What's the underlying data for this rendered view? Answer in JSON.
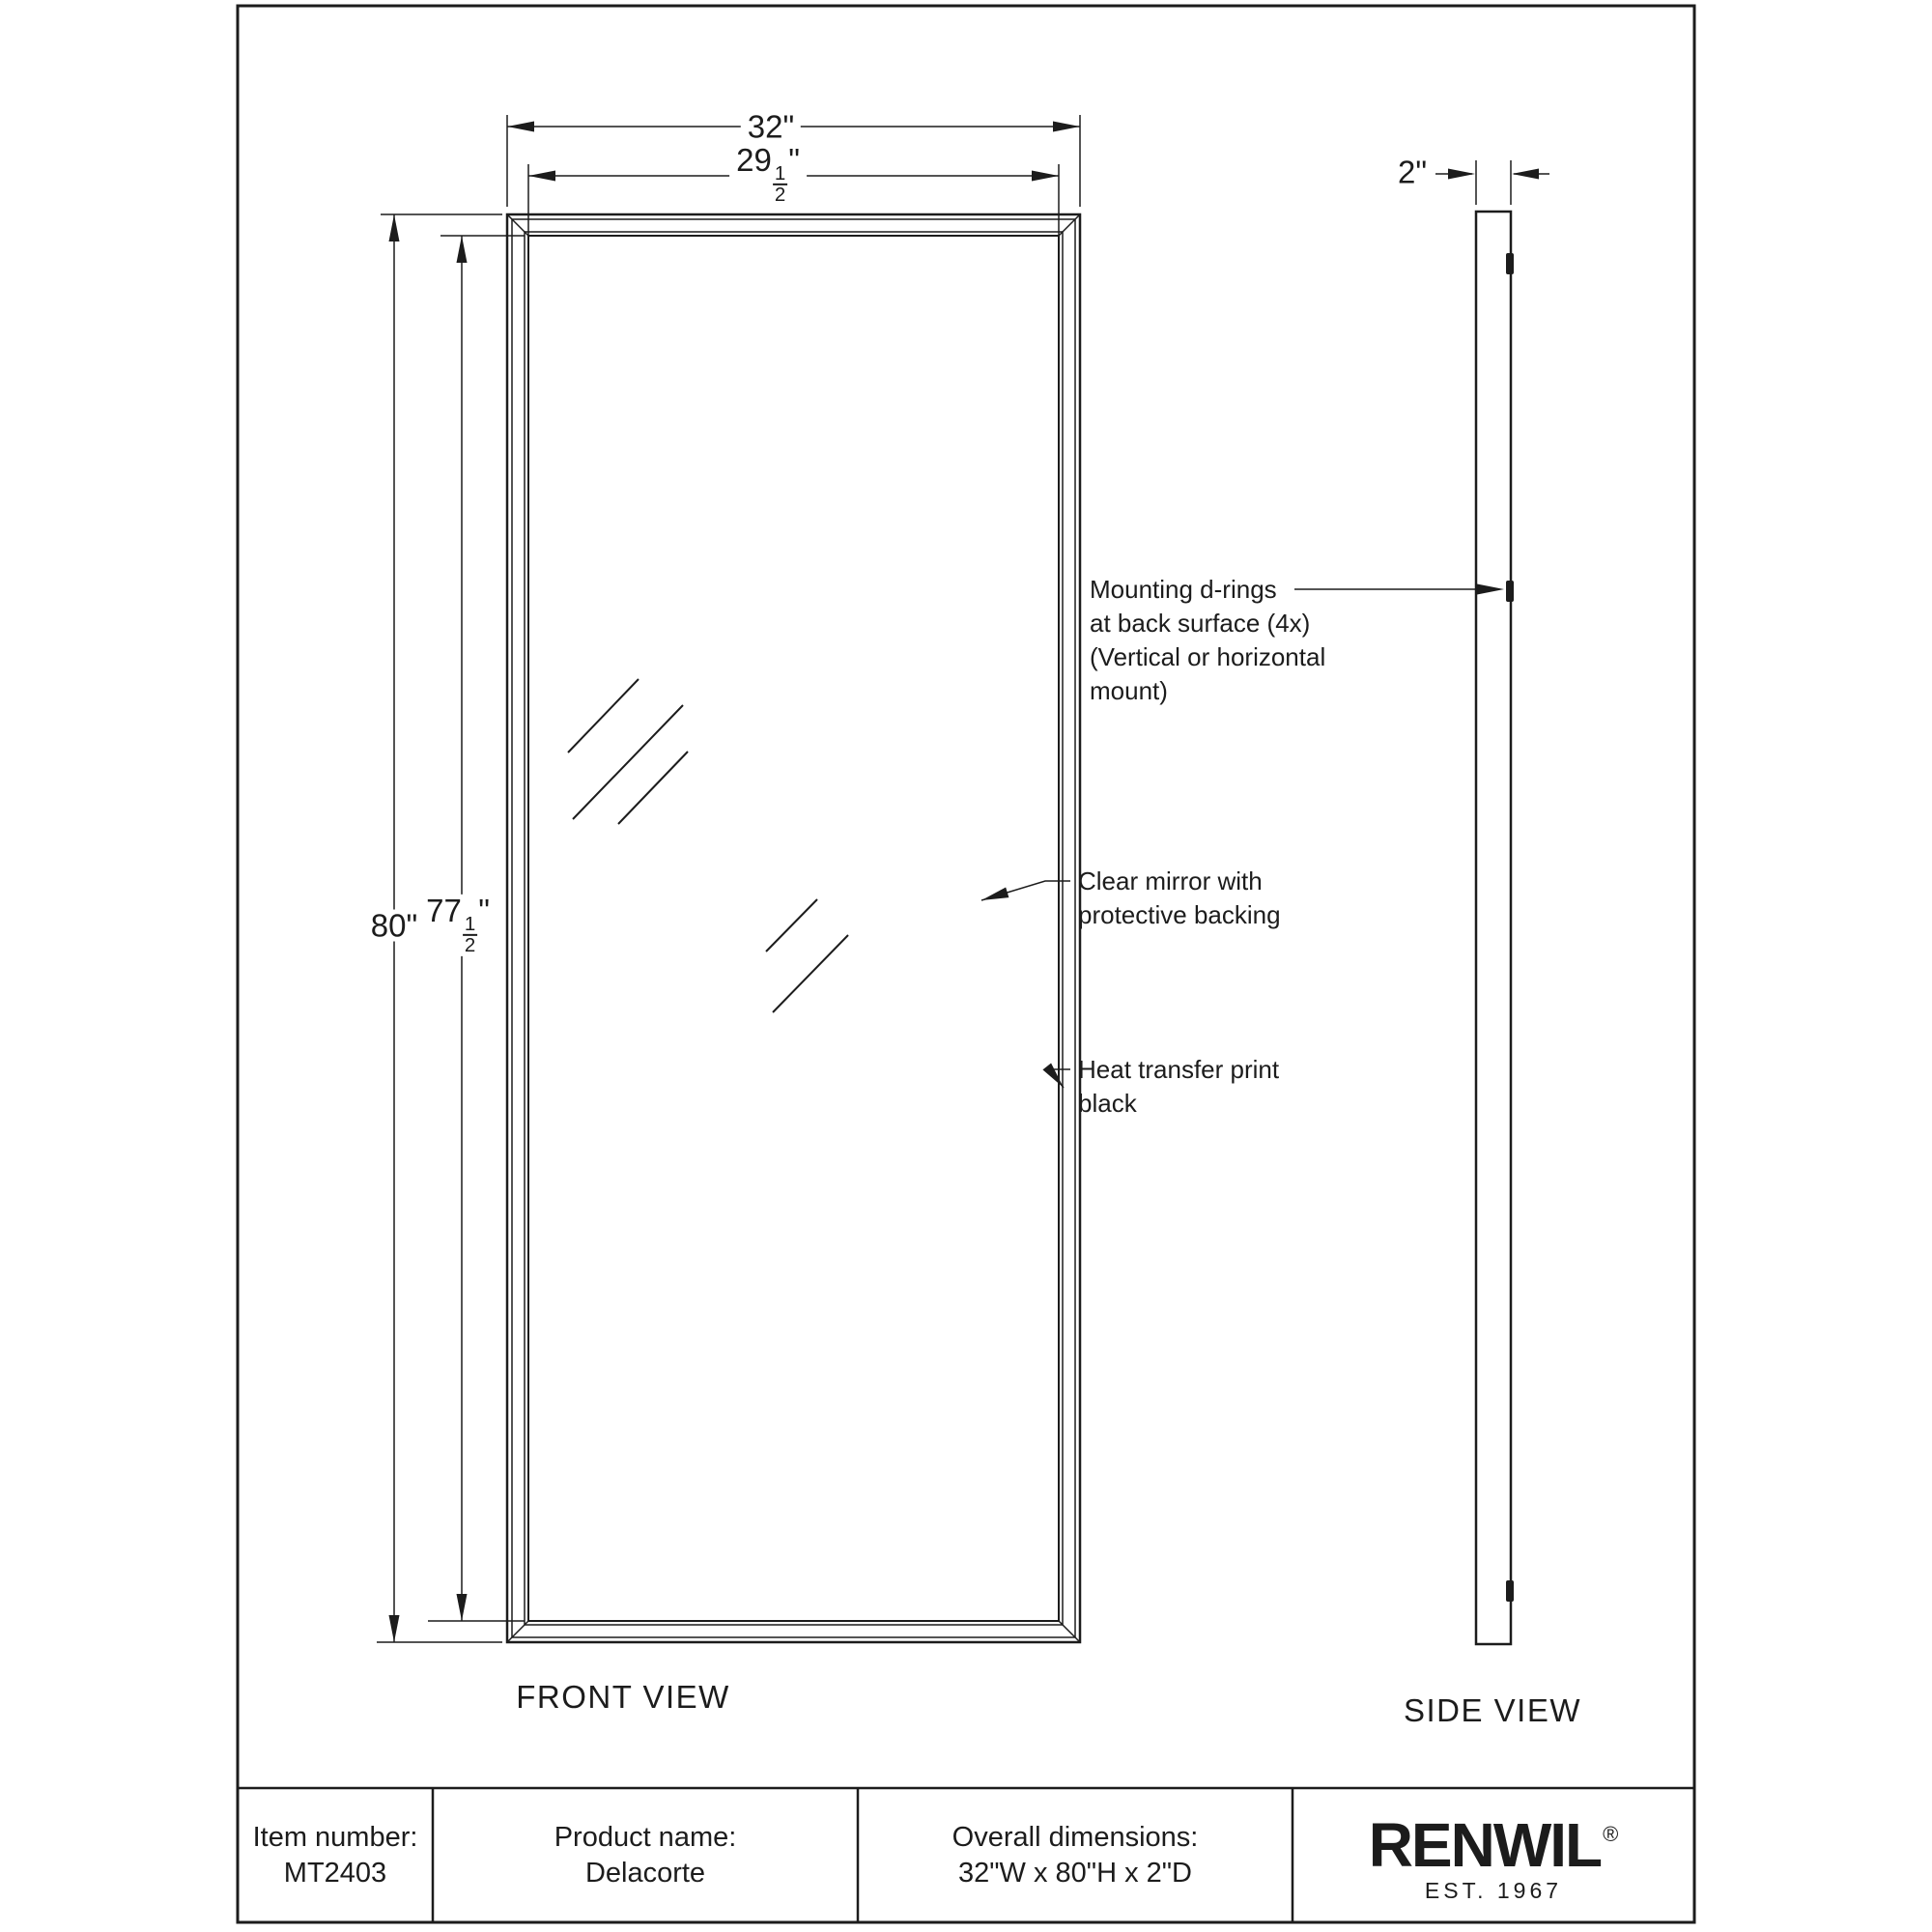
{
  "drawing": {
    "front_view": {
      "label": "FRONT VIEW",
      "width_outer": {
        "text": "32\""
      },
      "width_inner": {
        "whole": "29",
        "numerator": "1",
        "denominator": "2",
        "unit": "\""
      },
      "height_outer": {
        "text": "80\""
      },
      "height_inner": {
        "whole": "77",
        "numerator": "1",
        "denominator": "2",
        "unit": "\""
      }
    },
    "side_view": {
      "label": "SIDE VIEW",
      "depth": {
        "text": "2\""
      }
    },
    "annotations": {
      "mounting_drings": {
        "lines": [
          "Mounting d-rings",
          "at back surface (4x)",
          "(Vertical or horizontal",
          "mount)"
        ]
      },
      "clear_mirror": {
        "lines": [
          "Clear mirror with",
          "protective backing"
        ]
      },
      "heat_transfer": {
        "lines": [
          "Heat transfer print",
          "black"
        ]
      }
    }
  },
  "title_block": {
    "item": {
      "label": "Item number:",
      "value": "MT2403"
    },
    "product": {
      "label": "Product name:",
      "value": "Delacorte"
    },
    "dimensions": {
      "label": "Overall dimensions:",
      "value": "32\"W x 80\"H x 2\"D"
    },
    "brand": {
      "name": "RENWIL",
      "registered": "®",
      "established": "EST. 1967"
    }
  },
  "colors": {
    "line": "#1c1c1c",
    "background": "#ffffff"
  }
}
